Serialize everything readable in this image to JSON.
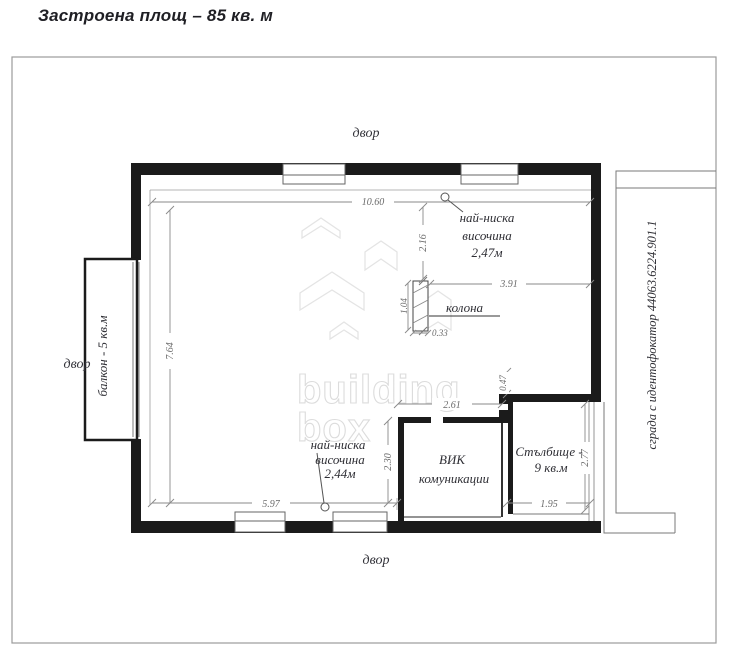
{
  "title": "Застроена площ – 85 кв. м",
  "plan": {
    "labels": {
      "yard_top": "двор",
      "yard_left": "двор",
      "yard_bottom": "двор",
      "balcony": "балкон - 5 кв.м",
      "neighbor_building": "сграда с идентофокатор 44063.6224.901.1",
      "column": "колона",
      "vik_room_line1": "ВИК",
      "vik_room_line2": "комуникации",
      "stairs_line1": "Стълбище -",
      "stairs_line2": "9 кв.м",
      "min_height_top_line1": "най-ниска",
      "min_height_top_line2": "височина",
      "min_height_top_line3": "2,47м",
      "min_height_bottom_line1": "най-ниска",
      "min_height_bottom_line2": "височина",
      "min_height_bottom_line3": "2,44м"
    },
    "dimensions": {
      "top_width": "10.60",
      "column_drop": "2.16",
      "right_span": "3.91",
      "left_height": "7.64",
      "bottom_width": "5.97",
      "vik_height": "2.30",
      "vik_width": "2.61",
      "stub_height": "0.47",
      "stairs_width": "1.95",
      "stairs_height": "2.77",
      "column_height": "1.04",
      "column_width": "0.33"
    },
    "watermark": {
      "line1": "building",
      "line2": "box"
    },
    "colors": {
      "wall": "#1b1b1b",
      "thin_line": "#7a7a7a",
      "dimension_text": "#6a6a6a",
      "label_text": "#33333a",
      "watermark": "#dcdcdc"
    }
  }
}
